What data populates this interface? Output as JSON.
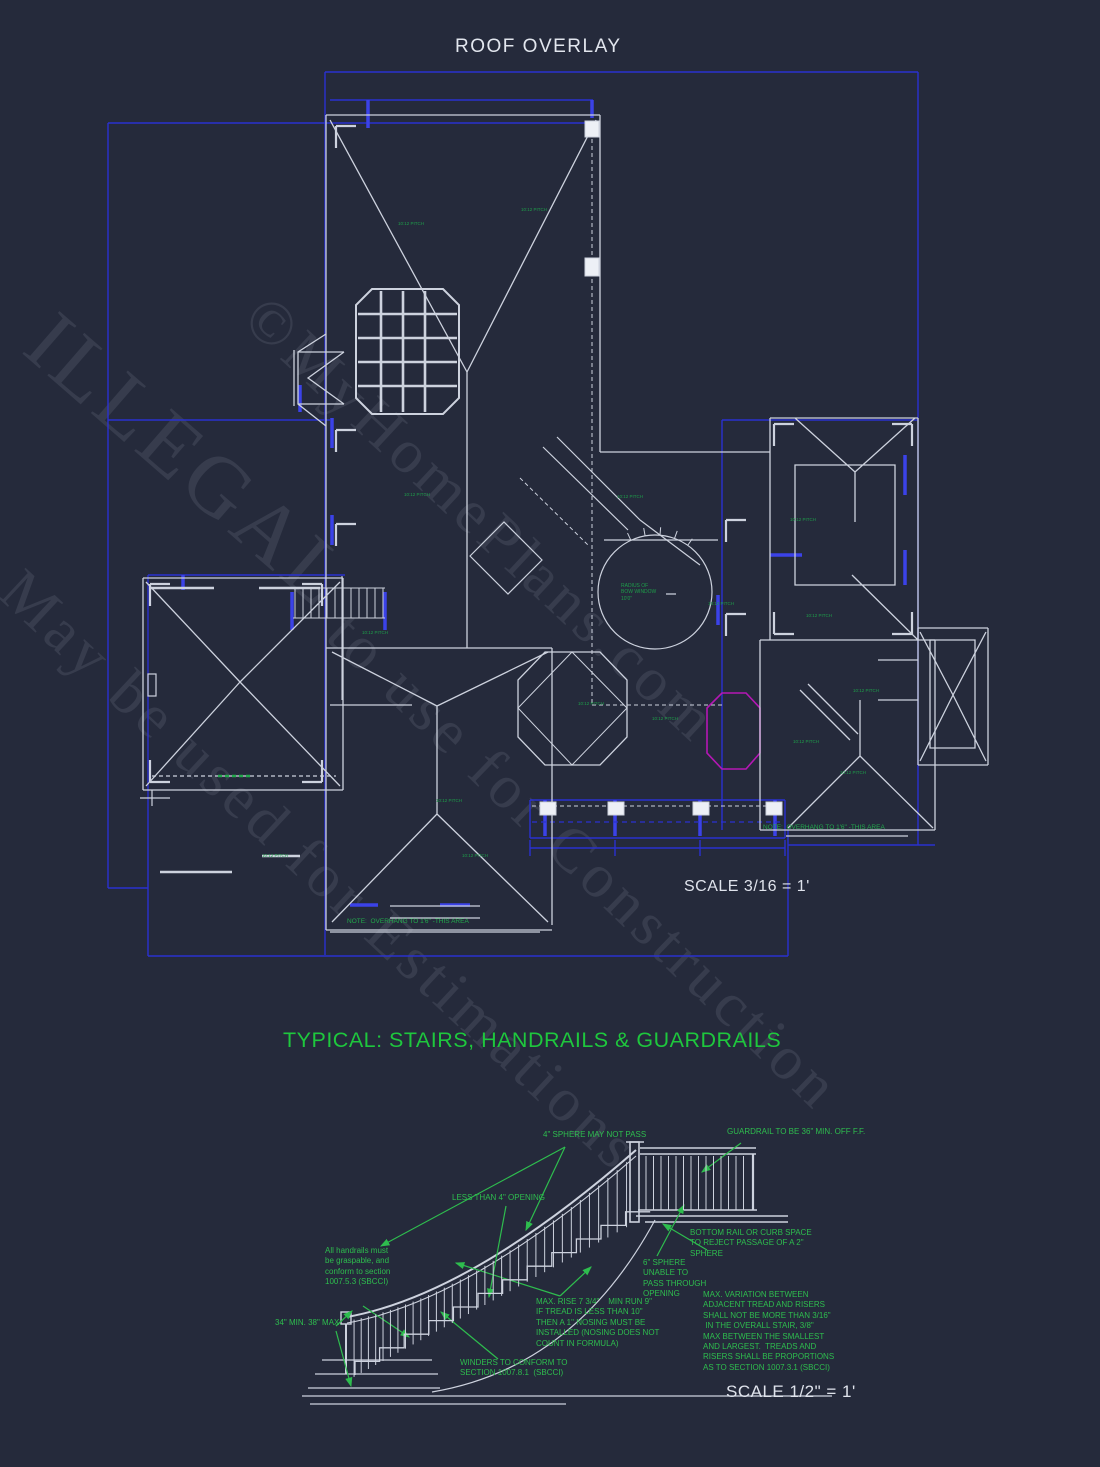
{
  "roof": {
    "title": "ROOF OVERLAY",
    "scale_label": "SCALE 3/16 = 1'",
    "note_right": "NOTE:  OVERHANG TO 1'6\" -THIS AREA",
    "note_bottom": "NOTE:  OVERHANG TO 1'6\" -THIS AREA",
    "bow_window_label": "RADIUS OF\nBOW WINDOW\n10'0\"",
    "pitch_labels": [
      {
        "text": "10:12 PITCH",
        "x": 398,
        "y": 221
      },
      {
        "text": "10:12 PITCH",
        "x": 521,
        "y": 207
      },
      {
        "text": "10:12 PITCH",
        "x": 404,
        "y": 492
      },
      {
        "text": "10:12 PITCH",
        "x": 617,
        "y": 494
      },
      {
        "text": "10:12 PITCH",
        "x": 790,
        "y": 517
      },
      {
        "text": "10:12 PITCH",
        "x": 708,
        "y": 601
      },
      {
        "text": "10:12 PITCH",
        "x": 806,
        "y": 613
      },
      {
        "text": "10:12 PITCH",
        "x": 578,
        "y": 701
      },
      {
        "text": "10:12 PITCH",
        "x": 652,
        "y": 716
      },
      {
        "text": "10:12 PITCH",
        "x": 793,
        "y": 739
      },
      {
        "text": "10:12 PITCH",
        "x": 436,
        "y": 798
      },
      {
        "text": "10:12 PITCH",
        "x": 462,
        "y": 853
      },
      {
        "text": "10:12 PITCH",
        "x": 840,
        "y": 770
      },
      {
        "text": "10:12 PITCH",
        "x": 262,
        "y": 853
      },
      {
        "text": "10:12 PITCH",
        "x": 362,
        "y": 630
      },
      {
        "text": "10:12 PITCH",
        "x": 853,
        "y": 688
      }
    ]
  },
  "stairs": {
    "title": "TYPICAL: STAIRS, HANDRAILS & GUARDRAILS",
    "scale_label": "SCALE 1/2\" = 1'",
    "notes": {
      "sphere4": "4\" SPHERE MAY NOT PASS",
      "guardrail36": "GUARDRAIL TO BE 36\" MIN. OFF F.F.",
      "less_than_4": "LESS THAN 4\" OPENING",
      "bottom_rail": "BOTTOM RAIL OR CURB SPACE\nTO REJECT PASSAGE OF A 2\"\nSPHERE",
      "sphere6": "6\" SPHERE\nUNABLE TO\nPASS THROUGH\nOPENING",
      "handrails": "All handrails must\nbe graspable, and\nconform to section\n1007.5.3 (SBCCI)",
      "height": "34\" MIN. 38\" MAX.",
      "rise_run": "MAX. RISE 7 3/4\"    MIN RUN 9\"\nIF TREAD IS LESS THAN 10\"\nTHEN A 1\" NOSING MUST BE\nINSTALLED (NOSING DOES NOT\nCOUNT IN FORMULA)",
      "variation": "MAX. VARIATION BETWEEN\nADJACENT TREAD AND RISERS\nSHALL NOT BE MORE THAN 3/16\"\n IN THE OVERALL STAIR, 3/8\"\nMAX BETWEEN THE SMALLEST\nAND LARGEST.  TREADS AND\nRISERS SHALL BE PROPORTIONS\nAS TO SECTION 1007.3.1 (SBCCI)",
      "winders": "WINDERS TO CONFORM TO\nSECTION 1007.8.1  (SBCCI)"
    }
  },
  "watermark": {
    "line1": "©MyHomePlans.com",
    "line2a": "ILLEGAL",
    "line2b": "to use for Construction",
    "line3": "May be used for Estimations"
  },
  "colors": {
    "background": "#252a3b",
    "line_white": "#cdd2de",
    "line_blue": "#2a31d0",
    "annotation_green": "#2ebd4e",
    "title_green": "#1ec73d",
    "octagon_magenta": "#b517b5"
  }
}
